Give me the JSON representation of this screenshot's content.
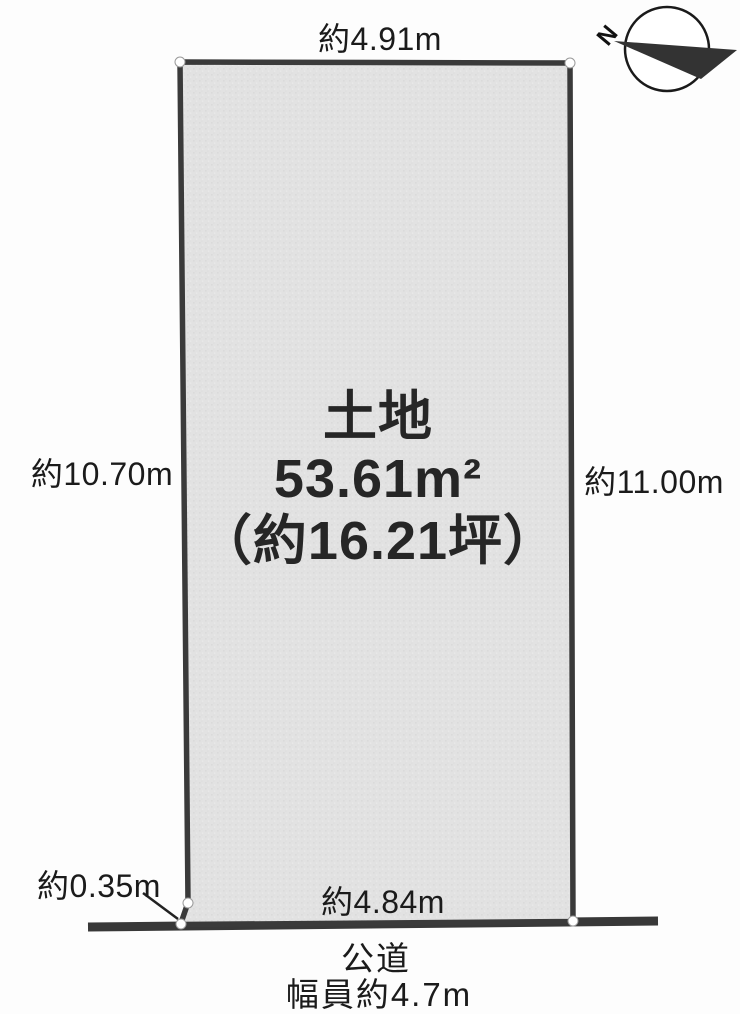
{
  "diagram": {
    "compass": {
      "north_label": "N"
    },
    "dimensions": {
      "top": "約4.91m",
      "left": "約10.70m",
      "right": "約11.00m",
      "bottom": "約4.84m",
      "offset": "約0.35m"
    },
    "parcel": {
      "title": "土地",
      "area_m2": "53.61m²",
      "area_tsubo": "（約16.21坪）"
    },
    "road": {
      "name": "公道",
      "width_note": "幅員約4.7m"
    },
    "colors": {
      "parcel_fill": "#e2e2e2",
      "outline": "#3a3a3a",
      "background": "#fdfdfd",
      "text": "#1b1b1b"
    }
  }
}
